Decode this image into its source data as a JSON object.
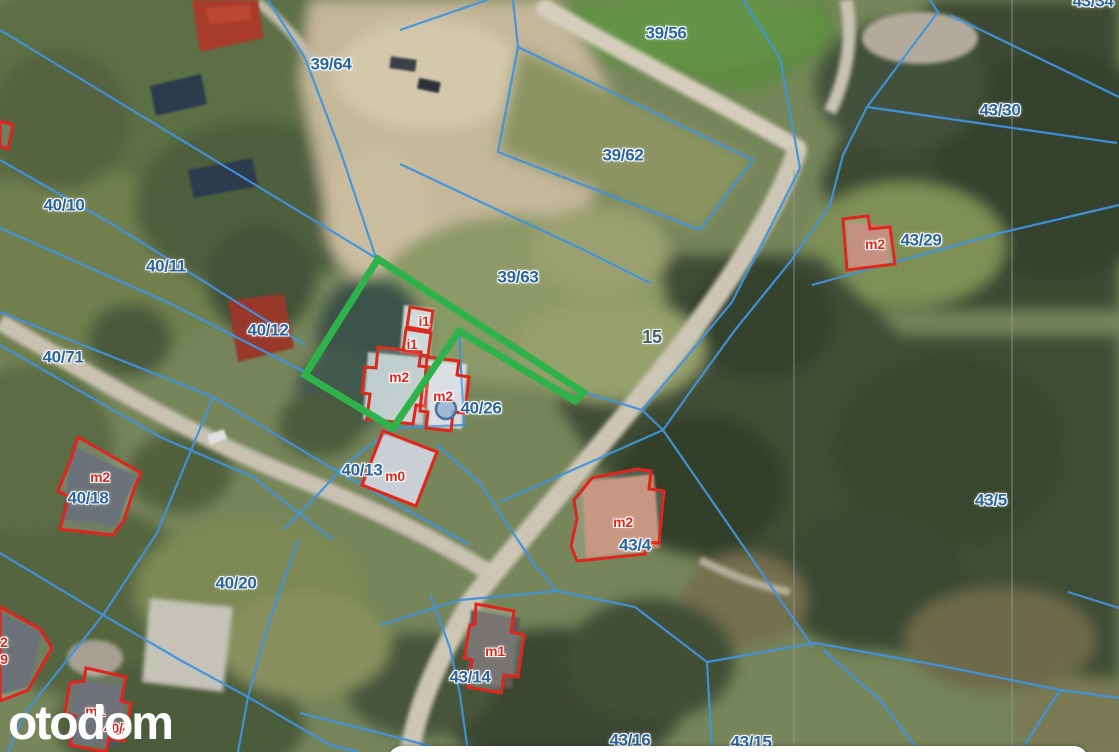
{
  "map": {
    "watermark": "otodom",
    "colors": {
      "parcel_line": "#3f93dc",
      "utility_line": "#9aa0a0",
      "building_outline": "#e1251c",
      "highlight_outline": "#2eb34b",
      "parcel_label": "#2b659c",
      "road_label": "#44606e",
      "building_label": "#d42b20",
      "marker_fill": "#8fb2d0",
      "marker_stroke": "#44719f",
      "watermark_color": "#ffffff"
    },
    "labels": [
      {
        "text": "39/64",
        "x": 331,
        "y": 64,
        "kind": "parcel"
      },
      {
        "text": "39/56",
        "x": 666,
        "y": 33,
        "kind": "parcel"
      },
      {
        "text": "43/34",
        "x": 1093,
        "y": 1,
        "kind": "parcel"
      },
      {
        "text": "43/30",
        "x": 1000,
        "y": 110,
        "kind": "parcel"
      },
      {
        "text": "40/10",
        "x": 64,
        "y": 205,
        "kind": "parcel"
      },
      {
        "text": "43/29",
        "x": 921,
        "y": 240,
        "kind": "parcel"
      },
      {
        "text": "40/11",
        "x": 166,
        "y": 266,
        "kind": "parcel"
      },
      {
        "text": "39/62",
        "x": 623,
        "y": 155,
        "kind": "parcel"
      },
      {
        "text": "40/12",
        "x": 268,
        "y": 330,
        "kind": "parcel"
      },
      {
        "text": "40/71",
        "x": 63,
        "y": 357,
        "kind": "parcel"
      },
      {
        "text": "39/63",
        "x": 518,
        "y": 277,
        "kind": "parcel"
      },
      {
        "text": "15",
        "x": 652,
        "y": 337,
        "kind": "road"
      },
      {
        "text": "40/26",
        "x": 481,
        "y": 408,
        "kind": "parcel"
      },
      {
        "text": "40/18",
        "x": 88,
        "y": 498,
        "kind": "parcel"
      },
      {
        "text": "40/13",
        "x": 362,
        "y": 470,
        "kind": "parcel"
      },
      {
        "text": "43/5",
        "x": 991,
        "y": 500,
        "kind": "parcel"
      },
      {
        "text": "43/4",
        "x": 635,
        "y": 545,
        "kind": "parcel"
      },
      {
        "text": "40/20",
        "x": 236,
        "y": 583,
        "kind": "parcel"
      },
      {
        "text": "43/14",
        "x": 470,
        "y": 677,
        "kind": "parcel"
      },
      {
        "text": "43/16",
        "x": 630,
        "y": 740,
        "kind": "parcel"
      },
      {
        "text": "43/15",
        "x": 751,
        "y": 742,
        "kind": "parcel"
      },
      {
        "text": "m2",
        "x": 875,
        "y": 244,
        "kind": "building"
      },
      {
        "text": "i1",
        "x": 424,
        "y": 321,
        "kind": "building"
      },
      {
        "text": "i1",
        "x": 412,
        "y": 344,
        "kind": "building"
      },
      {
        "text": "m2",
        "x": 399,
        "y": 377,
        "kind": "building"
      },
      {
        "text": "m2",
        "x": 443,
        "y": 396,
        "kind": "building"
      },
      {
        "text": "m2",
        "x": 100,
        "y": 477,
        "kind": "building"
      },
      {
        "text": "m0",
        "x": 395,
        "y": 476,
        "kind": "building"
      },
      {
        "text": "m2",
        "x": 623,
        "y": 522,
        "kind": "building"
      },
      {
        "text": "m1",
        "x": 495,
        "y": 651,
        "kind": "building"
      },
      {
        "text": "m1",
        "x": 95,
        "y": 711,
        "kind": "building"
      },
      {
        "text": "2",
        "x": 4,
        "y": 642,
        "kind": "building"
      },
      {
        "text": "9",
        "x": 4,
        "y": 659,
        "kind": "building"
      },
      {
        "text": "40/4",
        "x": 117,
        "y": 728,
        "kind": "building"
      }
    ],
    "highlight_plot": {
      "points": [
        [
          378,
          259
        ],
        [
          583,
          392
        ],
        [
          575,
          401
        ],
        [
          459,
          331
        ],
        [
          393,
          428
        ],
        [
          305,
          375
        ]
      ]
    },
    "marker": {
      "x": 446,
      "y": 409,
      "r": 10
    },
    "parcel_lines": [
      [
        [
          0,
          30
        ],
        [
          376,
          258
        ]
      ],
      [
        [
          0,
          160
        ],
        [
          117,
          227
        ],
        [
          305,
          345
        ]
      ],
      [
        [
          0,
          228
        ],
        [
          167,
          302
        ],
        [
          305,
          372
        ]
      ],
      [
        [
          0,
          312
        ],
        [
          213,
          397
        ],
        [
          330,
          467
        ],
        [
          470,
          545
        ]
      ],
      [
        [
          0,
          345
        ],
        [
          160,
          437
        ],
        [
          253,
          477
        ],
        [
          333,
          540
        ]
      ],
      [
        [
          213,
          397
        ],
        [
          157,
          533
        ],
        [
          103,
          615
        ],
        [
          25,
          713
        ],
        [
          8,
          752
        ]
      ],
      [
        [
          0,
          553
        ],
        [
          103,
          615
        ],
        [
          180,
          660
        ],
        [
          248,
          697
        ],
        [
          330,
          745
        ],
        [
          358,
          752
        ]
      ],
      [
        [
          268,
          0
        ],
        [
          305,
          58
        ],
        [
          340,
          150
        ],
        [
          376,
          258
        ]
      ],
      [
        [
          518,
          47
        ],
        [
          753,
          160
        ],
        [
          700,
          230
        ],
        [
          498,
          152
        ],
        [
          518,
          47
        ]
      ],
      [
        [
          400,
          164
        ],
        [
          500,
          211
        ],
        [
          580,
          248
        ],
        [
          650,
          283
        ]
      ],
      [
        [
          513,
          0
        ],
        [
          518,
          47
        ]
      ],
      [
        [
          400,
          30
        ],
        [
          487,
          0
        ]
      ],
      [
        [
          743,
          0
        ],
        [
          780,
          58
        ],
        [
          800,
          168
        ]
      ],
      [
        [
          950,
          15
        ],
        [
          1119,
          97
        ]
      ],
      [
        [
          930,
          0
        ],
        [
          938,
          12
        ],
        [
          867,
          107
        ],
        [
          843,
          155
        ],
        [
          830,
          205
        ]
      ],
      [
        [
          867,
          107
        ],
        [
          1117,
          143
        ]
      ],
      [
        [
          812,
          285
        ],
        [
          1000,
          233
        ],
        [
          1119,
          205
        ]
      ],
      [
        [
          800,
          168
        ],
        [
          768,
          232
        ],
        [
          732,
          302
        ],
        [
          680,
          365
        ],
        [
          642,
          410
        ]
      ],
      [
        [
          830,
          205
        ],
        [
          790,
          262
        ],
        [
          735,
          330
        ],
        [
          695,
          385
        ],
        [
          663,
          430
        ]
      ],
      [
        [
          583,
          392
        ],
        [
          642,
          410
        ]
      ],
      [
        [
          642,
          410
        ],
        [
          663,
          430
        ],
        [
          813,
          647
        ]
      ],
      [
        [
          663,
          430
        ],
        [
          550,
          480
        ],
        [
          500,
          502
        ]
      ],
      [
        [
          380,
          625
        ],
        [
          460,
          600
        ],
        [
          557,
          591
        ],
        [
          635,
          607
        ],
        [
          707,
          662
        ]
      ],
      [
        [
          707,
          662
        ],
        [
          712,
          752
        ]
      ],
      [
        [
          707,
          662
        ],
        [
          815,
          643
        ],
        [
          947,
          667
        ],
        [
          1060,
          690
        ],
        [
          1119,
          698
        ]
      ],
      [
        [
          823,
          650
        ],
        [
          880,
          700
        ],
        [
          920,
          752
        ]
      ],
      [
        [
          1060,
          690
        ],
        [
          1020,
          752
        ]
      ],
      [
        [
          460,
          695
        ],
        [
          468,
          752
        ]
      ],
      [
        [
          300,
          713
        ],
        [
          380,
          733
        ],
        [
          445,
          750
        ]
      ],
      [
        [
          437,
          445
        ],
        [
          480,
          483
        ],
        [
          533,
          563
        ],
        [
          557,
          591
        ]
      ],
      [
        [
          392,
          428
        ],
        [
          345,
          465
        ],
        [
          310,
          503
        ],
        [
          283,
          530
        ]
      ],
      [
        [
          459,
          331
        ],
        [
          464,
          425
        ],
        [
          392,
          428
        ]
      ],
      [
        [
          430,
          595
        ],
        [
          450,
          648
        ],
        [
          460,
          695
        ]
      ],
      [
        [
          298,
          540
        ],
        [
          268,
          625
        ],
        [
          248,
          697
        ],
        [
          238,
          752
        ]
      ],
      [
        [
          1068,
          592
        ],
        [
          1119,
          608
        ]
      ]
    ],
    "utility_lines": [
      [
        [
          794,
          170
        ],
        [
          794,
          752
        ]
      ],
      [
        [
          1012,
          0
        ],
        [
          1012,
          752
        ]
      ]
    ],
    "buildings": [
      {
        "label": "m2-43-29",
        "points": [
          [
            843,
            219
          ],
          [
            868,
            216
          ],
          [
            870,
            229
          ],
          [
            890,
            227
          ],
          [
            895,
            264
          ],
          [
            847,
            270
          ]
        ]
      },
      {
        "label": "i1-a",
        "points": [
          [
            410,
            307
          ],
          [
            433,
            311
          ],
          [
            430,
            331
          ],
          [
            407,
            327
          ]
        ]
      },
      {
        "label": "i1-b",
        "points": [
          [
            406,
            329
          ],
          [
            431,
            333
          ],
          [
            428,
            356
          ],
          [
            403,
            352
          ]
        ]
      },
      {
        "label": "m2-main",
        "points": [
          [
            378,
            347
          ],
          [
            421,
            352
          ],
          [
            419,
            366
          ],
          [
            429,
            367
          ],
          [
            425,
            406
          ],
          [
            416,
            405
          ],
          [
            413,
            424
          ],
          [
            367,
            419
          ],
          [
            370,
            394
          ],
          [
            362,
            393
          ],
          [
            365,
            367
          ],
          [
            376,
            368
          ]
        ]
      },
      {
        "label": "m2-40-26",
        "points": [
          [
            427,
            357
          ],
          [
            459,
            361
          ],
          [
            457,
            375
          ],
          [
            469,
            377
          ],
          [
            465,
            413
          ],
          [
            453,
            412
          ],
          [
            451,
            431
          ],
          [
            426,
            428
          ],
          [
            428,
            412
          ],
          [
            420,
            411
          ],
          [
            423,
            381
          ],
          [
            425,
            380
          ]
        ]
      },
      {
        "label": "m2-40-18",
        "points": [
          [
            78,
            437
          ],
          [
            141,
            473
          ],
          [
            134,
            489
          ],
          [
            124,
            520
          ],
          [
            113,
            535
          ],
          [
            60,
            529
          ],
          [
            69,
            497
          ],
          [
            58,
            491
          ],
          [
            71,
            459
          ]
        ]
      },
      {
        "label": "m0-40-13",
        "points": [
          [
            383,
            431
          ],
          [
            437,
            452
          ],
          [
            416,
            506
          ],
          [
            362,
            485
          ]
        ]
      },
      {
        "label": "m2-43-4",
        "points": [
          [
            637,
            469
          ],
          [
            651,
            471
          ],
          [
            649,
            489
          ],
          [
            664,
            491
          ],
          [
            659,
            543
          ],
          [
            646,
            542
          ],
          [
            645,
            554
          ],
          [
            577,
            561
          ],
          [
            571,
            546
          ],
          [
            577,
            519
          ],
          [
            574,
            500
          ],
          [
            592,
            478
          ]
        ]
      },
      {
        "label": "m1-43-14",
        "points": [
          [
            476,
            604
          ],
          [
            514,
            611
          ],
          [
            511,
            632
          ],
          [
            524,
            635
          ],
          [
            518,
            677
          ],
          [
            504,
            675
          ],
          [
            501,
            693
          ],
          [
            468,
            687
          ],
          [
            472,
            660
          ],
          [
            464,
            658
          ],
          [
            470,
            625
          ],
          [
            475,
            624
          ]
        ]
      },
      {
        "label": "m1-bottom-left",
        "points": [
          [
            86,
            668
          ],
          [
            126,
            677
          ],
          [
            121,
            701
          ],
          [
            131,
            704
          ],
          [
            124,
            741
          ],
          [
            109,
            738
          ],
          [
            106,
            752
          ],
          [
            70,
            745
          ],
          [
            75,
            716
          ],
          [
            65,
            713
          ],
          [
            70,
            683
          ],
          [
            84,
            681
          ]
        ]
      },
      {
        "label": "partial-left-edge",
        "points": [
          [
            0,
            607
          ],
          [
            40,
            629
          ],
          [
            52,
            648
          ],
          [
            28,
            690
          ],
          [
            0,
            701
          ]
        ]
      },
      {
        "label": "partial-far-left",
        "points": [
          [
            0,
            121
          ],
          [
            13,
            125
          ],
          [
            8,
            149
          ],
          [
            0,
            146
          ]
        ]
      }
    ]
  }
}
